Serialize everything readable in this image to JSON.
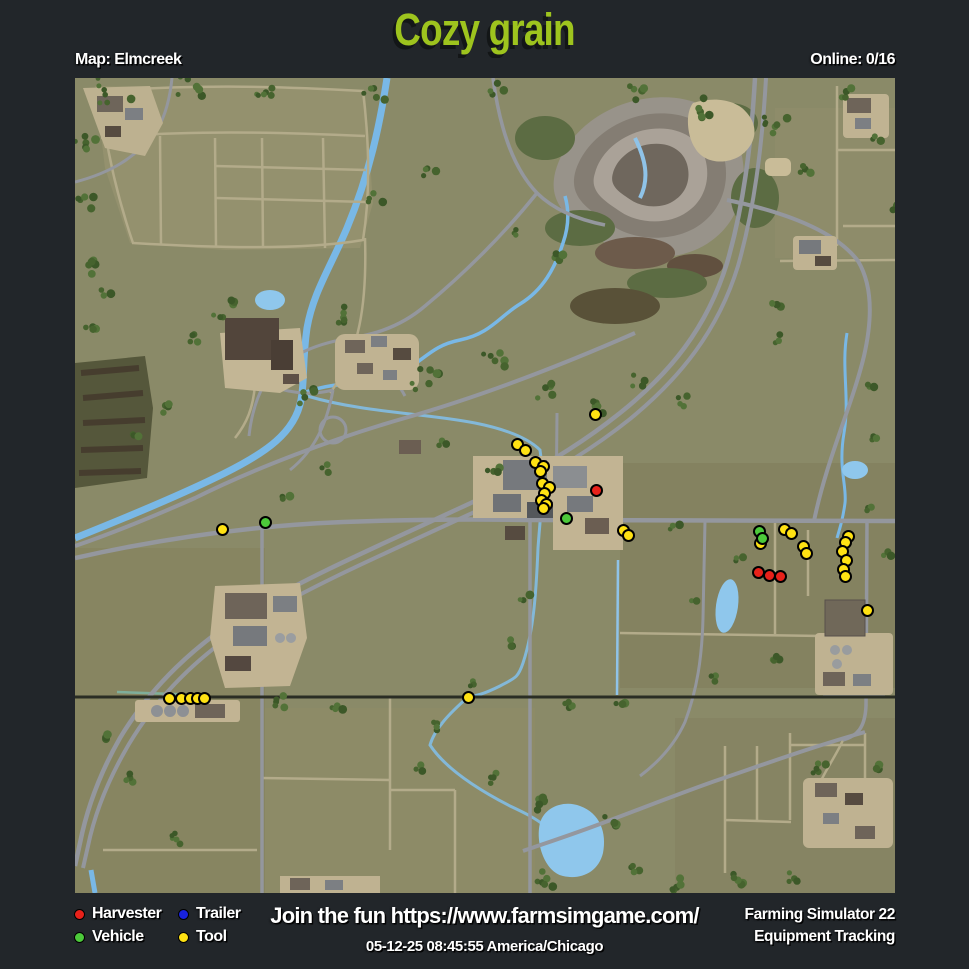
{
  "header": {
    "title": "Cozy grain",
    "map_label": "Map: Elmcreek",
    "online_label": "Online: 0/16"
  },
  "footer": {
    "promo": "Join the fun https://www.farmsimgame.com/",
    "timestamp": "05-12-25 08:45:55 America/Chicago",
    "app_line1": "Farming Simulator 22",
    "app_line2": "Equipment Tracking",
    "legend": [
      {
        "type": "harvester",
        "label": "Harvester",
        "color": "#e8211a"
      },
      {
        "type": "vehicle",
        "label": "Vehicle",
        "color": "#4cc93a"
      },
      {
        "type": "trailer",
        "label": "Trailer",
        "color": "#1822dd"
      },
      {
        "type": "tool",
        "label": "Tool",
        "color": "#ffe213"
      }
    ]
  },
  "map": {
    "name": "Elmcreek",
    "marker_colors": {
      "harvester": "#e8211a",
      "vehicle": "#4cc93a",
      "trailer": "#1822dd",
      "tool": "#ffe213"
    },
    "markers": [
      {
        "type": "tool",
        "x": 595,
        "y": 414
      },
      {
        "type": "tool",
        "x": 517,
        "y": 444
      },
      {
        "type": "tool",
        "x": 525,
        "y": 450
      },
      {
        "type": "tool",
        "x": 535,
        "y": 462
      },
      {
        "type": "tool",
        "x": 543,
        "y": 466
      },
      {
        "type": "tool",
        "x": 540,
        "y": 471
      },
      {
        "type": "tool",
        "x": 542,
        "y": 483
      },
      {
        "type": "tool",
        "x": 549,
        "y": 487
      },
      {
        "type": "tool",
        "x": 544,
        "y": 493
      },
      {
        "type": "tool",
        "x": 541,
        "y": 500
      },
      {
        "type": "tool",
        "x": 546,
        "y": 504
      },
      {
        "type": "tool",
        "x": 543,
        "y": 508
      },
      {
        "type": "tool",
        "x": 222,
        "y": 529
      },
      {
        "type": "tool",
        "x": 623,
        "y": 530
      },
      {
        "type": "tool",
        "x": 628,
        "y": 535
      },
      {
        "type": "tool",
        "x": 760,
        "y": 543
      },
      {
        "type": "tool",
        "x": 784,
        "y": 529
      },
      {
        "type": "tool",
        "x": 791,
        "y": 533
      },
      {
        "type": "tool",
        "x": 803,
        "y": 546
      },
      {
        "type": "tool",
        "x": 806,
        "y": 553
      },
      {
        "type": "tool",
        "x": 848,
        "y": 536
      },
      {
        "type": "tool",
        "x": 845,
        "y": 542
      },
      {
        "type": "tool",
        "x": 842,
        "y": 551
      },
      {
        "type": "tool",
        "x": 846,
        "y": 560
      },
      {
        "type": "tool",
        "x": 843,
        "y": 569
      },
      {
        "type": "tool",
        "x": 845,
        "y": 576
      },
      {
        "type": "tool",
        "x": 867,
        "y": 610
      },
      {
        "type": "tool",
        "x": 169,
        "y": 698
      },
      {
        "type": "tool",
        "x": 181,
        "y": 698
      },
      {
        "type": "tool",
        "x": 190,
        "y": 698
      },
      {
        "type": "tool",
        "x": 197,
        "y": 698
      },
      {
        "type": "tool",
        "x": 204,
        "y": 698
      },
      {
        "type": "tool",
        "x": 468,
        "y": 697
      },
      {
        "type": "vehicle",
        "x": 265,
        "y": 522
      },
      {
        "type": "vehicle",
        "x": 566,
        "y": 518
      },
      {
        "type": "vehicle",
        "x": 759,
        "y": 531
      },
      {
        "type": "vehicle",
        "x": 762,
        "y": 538
      },
      {
        "type": "harvester",
        "x": 596,
        "y": 490
      },
      {
        "type": "harvester",
        "x": 758,
        "y": 572
      },
      {
        "type": "harvester",
        "x": 769,
        "y": 575
      },
      {
        "type": "harvester",
        "x": 780,
        "y": 576
      }
    ]
  }
}
